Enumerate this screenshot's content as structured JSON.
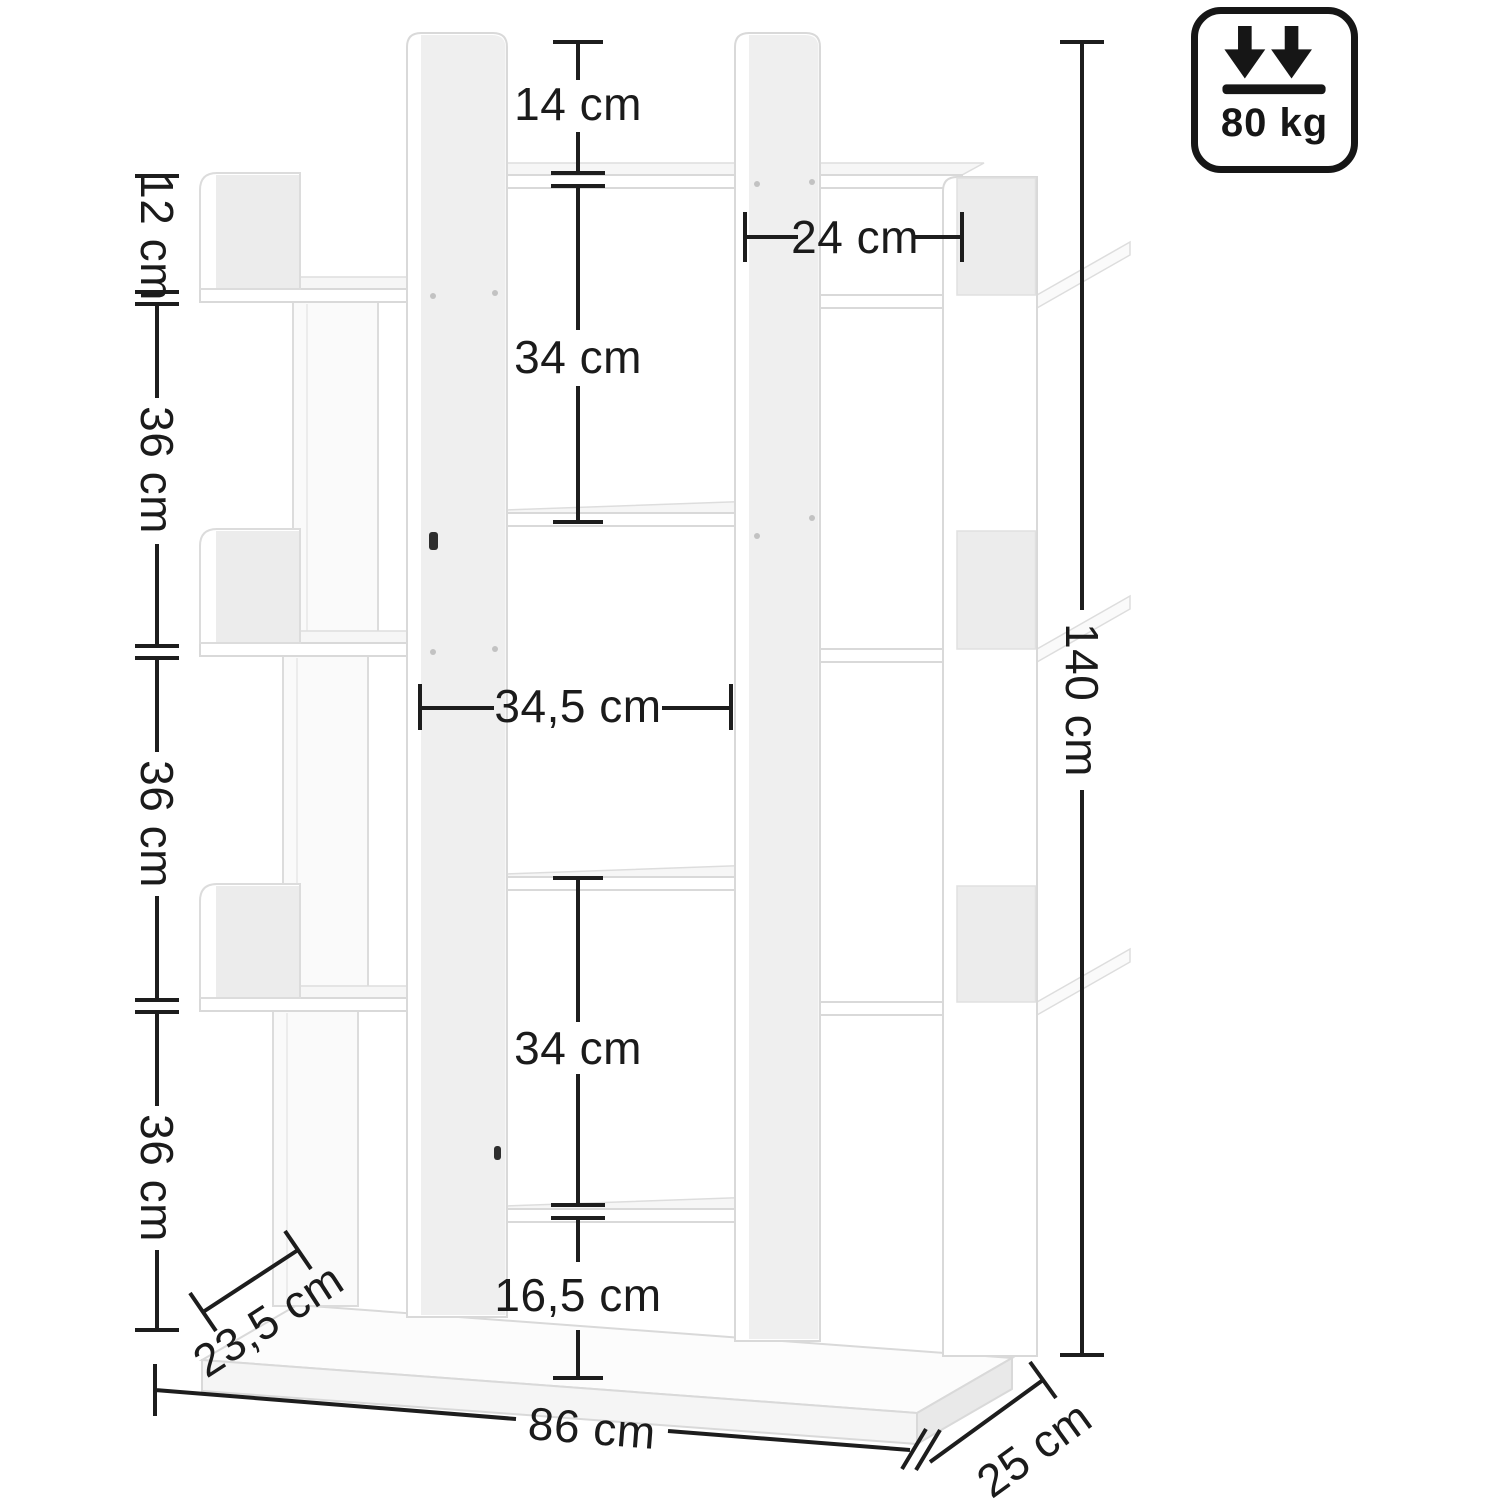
{
  "badge": {
    "max_load": "80 kg"
  },
  "dims": {
    "top_opening_height": "14 cm",
    "left_top_height": "12 cm",
    "left_upper_height": "36 cm",
    "left_middle_height": "36 cm",
    "left_lower_height": "36 cm",
    "right_opening_width": "24 cm",
    "center_upper_height": "34 cm",
    "center_width": "34,5 cm",
    "center_lower_height": "34 cm",
    "bottom_opening_height": "16,5 cm",
    "base_front_depth": "23,5 cm",
    "total_width": "86 cm",
    "total_depth": "25 cm",
    "total_height": "140 cm"
  }
}
